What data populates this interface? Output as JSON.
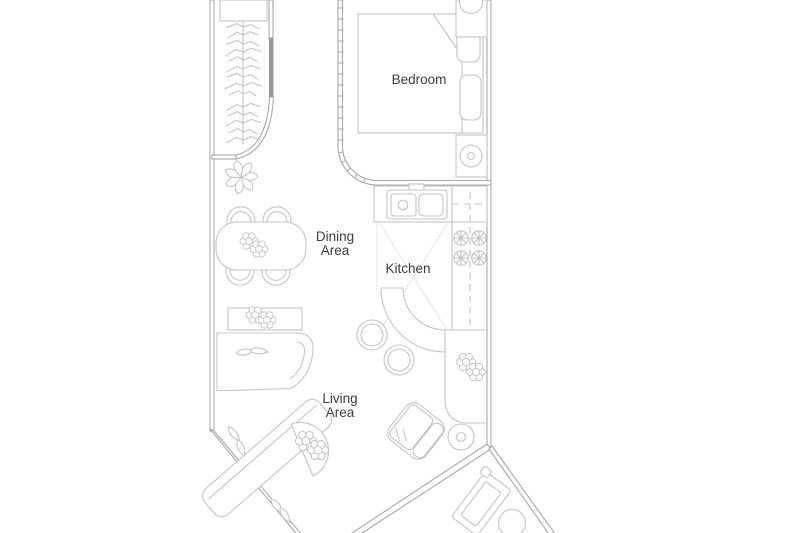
{
  "page": {
    "background": "#ffffff",
    "type": "apartment-floor-plan"
  },
  "colors": {
    "wall": "#a8a8a8",
    "furniture": "#c4c4c4",
    "faint": "#e4e4e4",
    "door": "#999999",
    "label": "#3d3d3d"
  },
  "rooms": {
    "bedroom": {
      "name": "Bedroom",
      "label_lines": [
        "Bedroom"
      ]
    },
    "dining": {
      "name": "Dining Area",
      "label_lines": [
        "Dining",
        "Area"
      ]
    },
    "kitchen": {
      "name": "Kitchen",
      "label_lines": [
        "Kitchen"
      ]
    },
    "living": {
      "name": "Living Area",
      "label_lines": [
        "Living",
        "Area"
      ]
    }
  }
}
